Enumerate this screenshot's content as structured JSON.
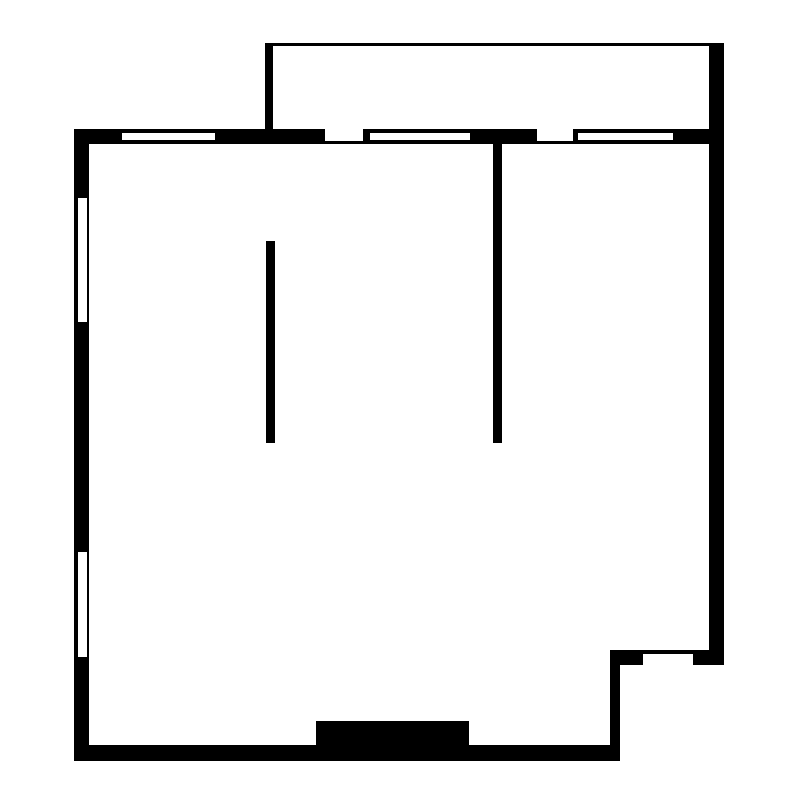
{
  "page": {
    "title": "Floor plan",
    "background": "#ffffff"
  },
  "canvas": {
    "width": 800,
    "height": 800
  },
  "colors": {
    "wall": "#000000",
    "opening": "#ffffff"
  },
  "elements": [
    {
      "name": "top-exterior-wall",
      "x": 74,
      "y": 129,
      "w": 650,
      "h": 15,
      "fill": "wall"
    },
    {
      "name": "left-exterior-wall",
      "x": 74,
      "y": 129,
      "w": 15,
      "h": 632,
      "fill": "wall"
    },
    {
      "name": "bottom-exterior-wall",
      "x": 74,
      "y": 745,
      "w": 546,
      "h": 16,
      "fill": "wall"
    },
    {
      "name": "right-exterior-wall",
      "x": 709,
      "y": 43,
      "w": 15,
      "h": 622,
      "fill": "wall"
    },
    {
      "name": "balcony-top-wall",
      "x": 265,
      "y": 43,
      "w": 459,
      "h": 3,
      "fill": "wall"
    },
    {
      "name": "balcony-left-wall",
      "x": 265,
      "y": 43,
      "w": 8,
      "h": 86,
      "fill": "wall"
    },
    {
      "name": "notch-vertical-wall",
      "x": 610,
      "y": 650,
      "w": 10,
      "h": 111,
      "fill": "wall"
    },
    {
      "name": "notch-horizontal-wall",
      "x": 610,
      "y": 650,
      "w": 114,
      "h": 15,
      "fill": "wall"
    },
    {
      "name": "interior-partition-left",
      "x": 266,
      "y": 241,
      "w": 9,
      "h": 202,
      "fill": "wall"
    },
    {
      "name": "interior-partition-right",
      "x": 493,
      "y": 143,
      "w": 9,
      "h": 300,
      "fill": "wall"
    },
    {
      "name": "entry-block",
      "x": 316,
      "y": 721,
      "w": 153,
      "h": 40,
      "fill": "wall"
    },
    {
      "name": "window-top-1",
      "x": 122,
      "y": 133,
      "w": 93,
      "h": 7,
      "fill": "opening"
    },
    {
      "name": "door-opening-top-1",
      "x": 325,
      "y": 129,
      "w": 38,
      "h": 12,
      "fill": "opening"
    },
    {
      "name": "window-top-2",
      "x": 370,
      "y": 133,
      "w": 100,
      "h": 7,
      "fill": "opening"
    },
    {
      "name": "door-opening-top-2",
      "x": 537,
      "y": 129,
      "w": 36,
      "h": 12,
      "fill": "opening"
    },
    {
      "name": "window-top-3",
      "x": 578,
      "y": 133,
      "w": 95,
      "h": 7,
      "fill": "opening"
    },
    {
      "name": "window-left-1",
      "x": 78,
      "y": 198,
      "w": 9,
      "h": 124,
      "fill": "opening"
    },
    {
      "name": "window-left-2",
      "x": 78,
      "y": 552,
      "w": 9,
      "h": 105,
      "fill": "opening"
    },
    {
      "name": "door-opening-notch",
      "x": 643,
      "y": 654,
      "w": 50,
      "h": 11,
      "fill": "opening"
    }
  ]
}
